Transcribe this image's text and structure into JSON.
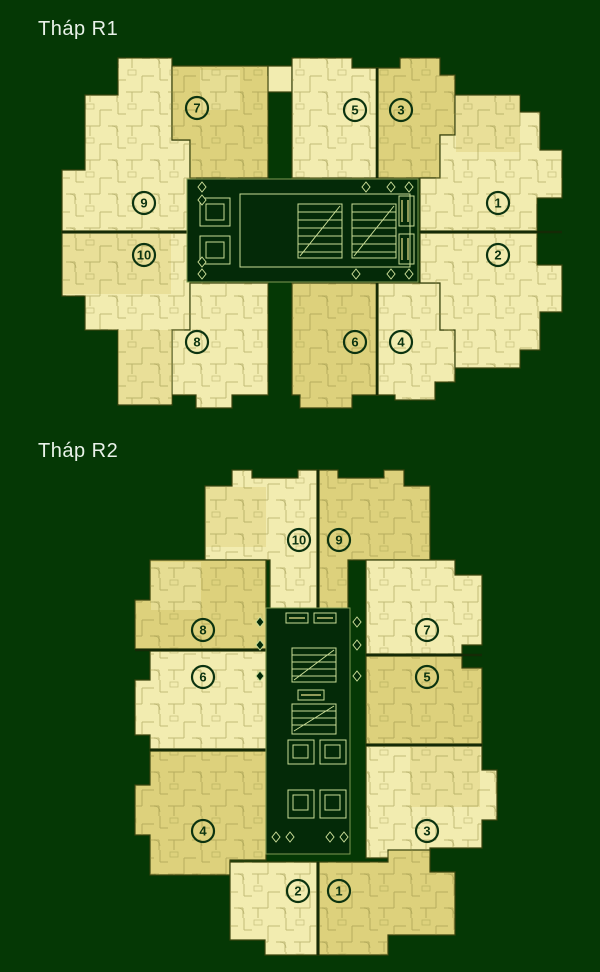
{
  "plans": {
    "r1": {
      "title": "Tháp R1",
      "units": {
        "u1": "1",
        "u2": "2",
        "u3": "3",
        "u4": "4",
        "u5": "5",
        "u6": "6",
        "u7": "7",
        "u8": "8",
        "u9": "9",
        "u10": "10"
      }
    },
    "r2": {
      "title": "Tháp R2",
      "units": {
        "u1": "1",
        "u2": "2",
        "u3": "3",
        "u4": "4",
        "u5": "5",
        "u6": "6",
        "u7": "7",
        "u8": "8",
        "u9": "9",
        "u10": "10"
      }
    }
  },
  "colors": {
    "background": "#053805",
    "unit_light": "#f2ecb0",
    "unit_khaki": "#ddd17c",
    "wall_line": "#8f893f",
    "unit_outline": "#39430e",
    "core_background": "#042a08",
    "core_line": "#c9dc96",
    "core_accent": "#e8e08a",
    "label_ink": "#0c3310",
    "title_text": "#e9f2e9"
  }
}
